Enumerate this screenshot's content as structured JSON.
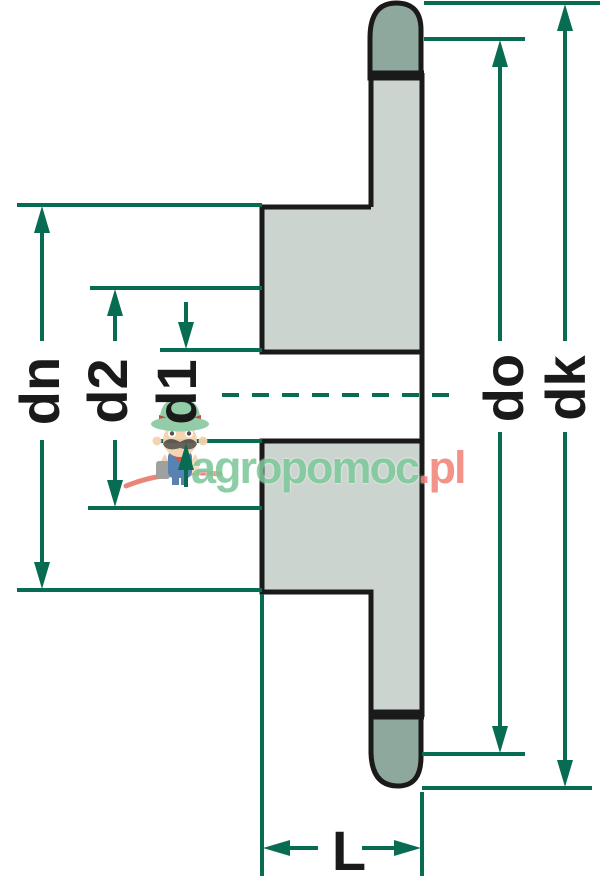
{
  "figure": {
    "type": "technical-drawing",
    "subject": "chain sprocket with hub, side cross-section with diameter and width dimensions",
    "labels": {
      "dn": "dn",
      "d2": "d2",
      "d1": "d1",
      "do": "do",
      "dk": "dk",
      "L": "L"
    }
  },
  "watermark": {
    "brand_green": "agropomoc",
    "brand_suffix": ".pl",
    "mascot": "farmer-mascot-icon"
  },
  "colors": {
    "dimension_green": "#076c52",
    "outline_black": "#1a1a1a",
    "body_fill": "#ccd4cf",
    "tooth_fill": "#8fa89d",
    "watermark_green": "#7ec89b",
    "watermark_pink": "#f18478",
    "swoosh_red": "#e97f70"
  }
}
